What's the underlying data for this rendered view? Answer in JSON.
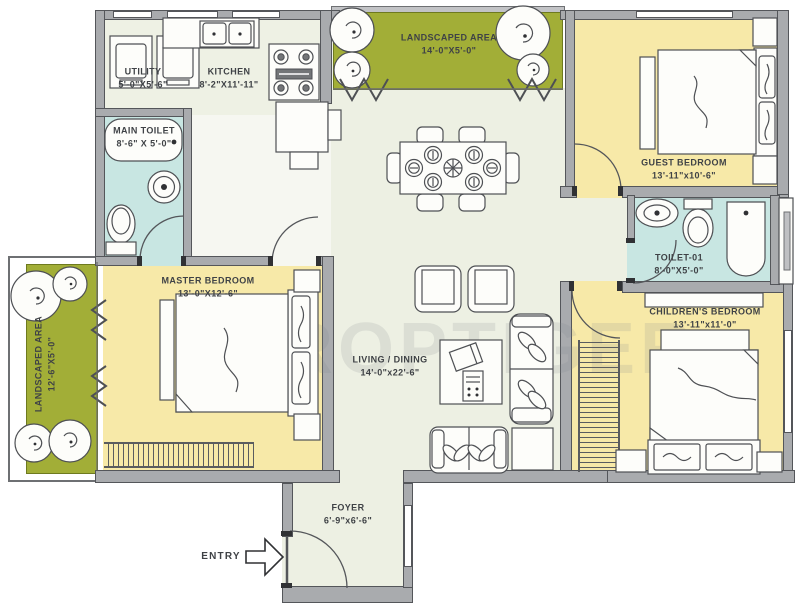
{
  "watermark": "PROPTIGER",
  "entry_label": "ENTRY",
  "rooms": {
    "utility": {
      "name": "UTILITY",
      "dims": "5'-0\"X5'-6\""
    },
    "kitchen": {
      "name": "KITCHEN",
      "dims": "8'-2\"X11'-11\""
    },
    "landscaped_top": {
      "name": "LANDSCAPED AREA",
      "dims": "14'-0\"X5'-0\""
    },
    "landscaped_left": {
      "name": "LANDSCAPED AREA",
      "dims": "12'-6\"X5'-0\""
    },
    "main_toilet": {
      "name": "MAIN TOILET",
      "dims": "8'-6\" X 5'-0\""
    },
    "guest_bedroom": {
      "name": "GUEST BEDROOM",
      "dims": "13'-11\"x10'-6\""
    },
    "master_bedroom": {
      "name": "MASTER BEDROOM",
      "dims": "13'-0\"X12'-6\""
    },
    "toilet_01": {
      "name": "TOILET-01",
      "dims": "8'-0\"X5'-0\""
    },
    "children_bedroom": {
      "name": "CHILDREN'S BEDROOM",
      "dims": "13'-11\"x11'-0\""
    },
    "living_dining": {
      "name": "LIVING / DINING",
      "dims": "14'-0\"x22'-6\""
    },
    "foyer": {
      "name": "FOYER",
      "dims": "6'-9\"x6'-6\""
    }
  },
  "colors": {
    "wall": "#a9abae",
    "floor": "#edf0e3",
    "bedroom": "#f7e9a8",
    "toilet": "#c8e6e2",
    "landscape": "#a2ae37"
  }
}
